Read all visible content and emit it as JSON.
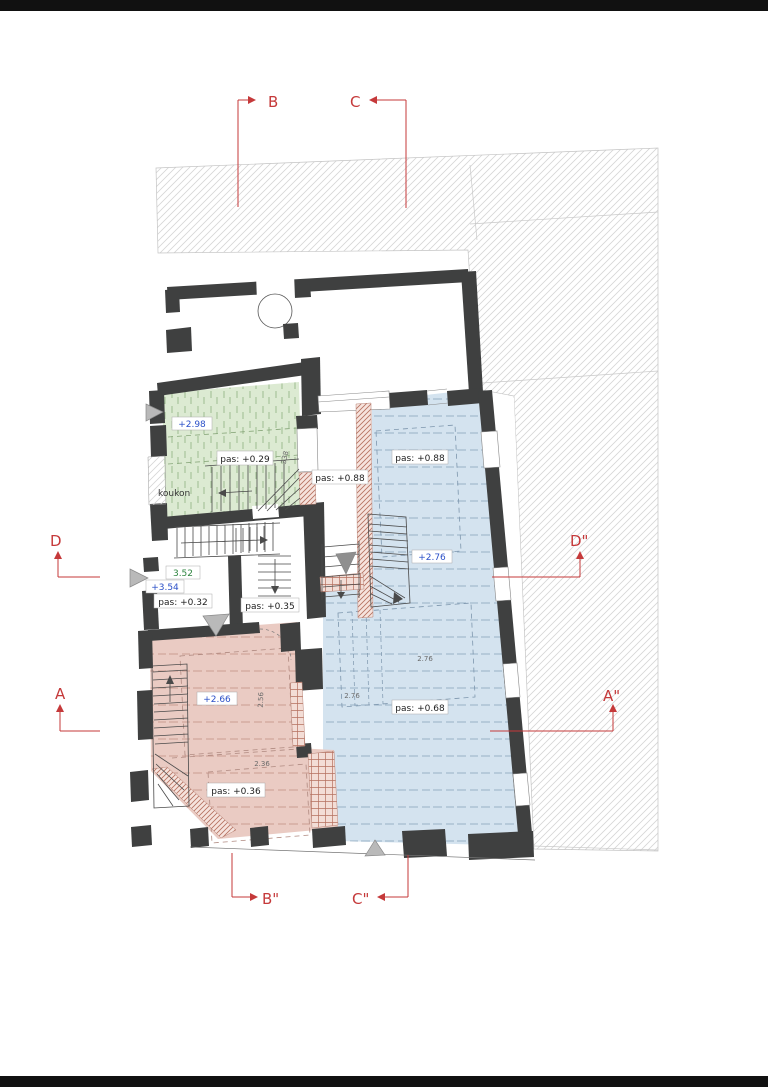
{
  "drawing": {
    "type": "architectural floor plan with section markers and level annotations"
  },
  "markers": {
    "b": "B",
    "c": "C",
    "d": "D",
    "d_prime": "D\"",
    "a": "A",
    "a_prime": "A\"",
    "b_prime": "B\"",
    "c_prime": "C\""
  },
  "labels": {
    "green_level": "+2.98",
    "green_pas": "pas: +0.29",
    "green_name": "koukon",
    "dim_338": "338",
    "hall_height": "3.52",
    "hall_level": "+3.54",
    "hall_pas": "pas: +0.32",
    "hall2_pas": "pas: +0.35",
    "corridor_pas": "pas: +0.88",
    "blue_pas_upper": "pas: +0.88",
    "blue_level": "+2.76",
    "blue_pas_lower": "pas: +0.68",
    "blue_dim_a": "2.76",
    "blue_dim_b": "2.76",
    "pink_level": "+2.66",
    "pink_pas": "pas: +0.36",
    "pink_dim": "2.36",
    "pink_dim_v": "2.56"
  },
  "colors": {
    "marker_red": "#c5393a",
    "wall_dark": "#3f4040",
    "room_green": "#dcead2",
    "room_blue": "#d4e3ef",
    "room_pink": "#eacbc3",
    "hatch_red": "#b5705f",
    "level_blue": "#2b50c8",
    "height_green": "#2e8540"
  }
}
